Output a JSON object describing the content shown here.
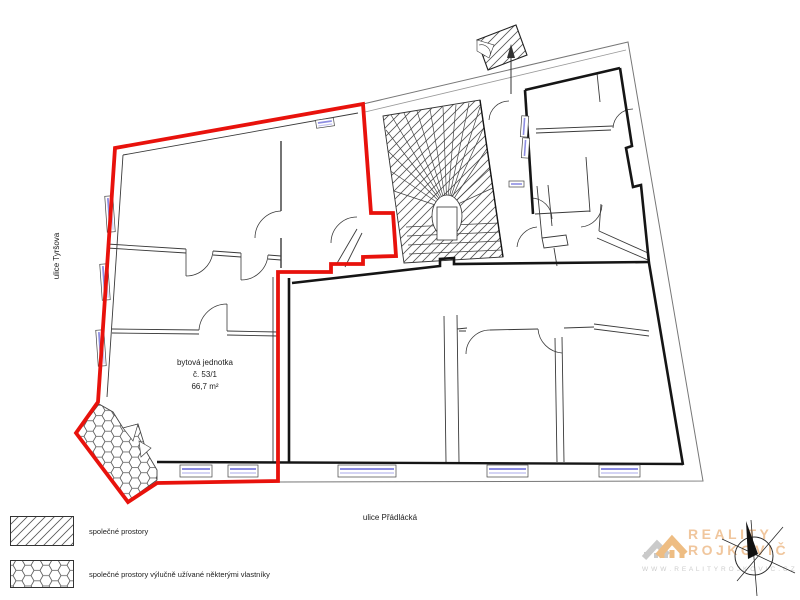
{
  "plan": {
    "unit": {
      "line1": "bytová jednotka",
      "line2": "č. 53/1",
      "line3": "66,7 m²"
    },
    "street_left": "ulice Tyršova",
    "street_bottom": "ulice Přádlácká"
  },
  "legend": {
    "items": [
      {
        "id": "diagonal-hatch",
        "label": "společné prostory"
      },
      {
        "id": "hex-hatch",
        "label": "společné prostory výlučně užívané některými vlastníky"
      }
    ]
  },
  "watermark": {
    "brand_top": "REALITY",
    "brand_bottom": "ROJKOVIČ",
    "website": "W W W . R E A L I T Y R O J K O V I C . C Z"
  },
  "icons": {
    "compass": "north-compass-icon",
    "logo": "house-roofs-icon"
  },
  "colors": {
    "unit_outline_red": "#e8120c",
    "wall_black": "#151515",
    "thin_line": "#555555",
    "window_blue": "#8d8de2",
    "window_blue_light": "#c5c5f2",
    "brand_orange": "#f0c69d",
    "brand_gray": "#cdcdcd"
  }
}
